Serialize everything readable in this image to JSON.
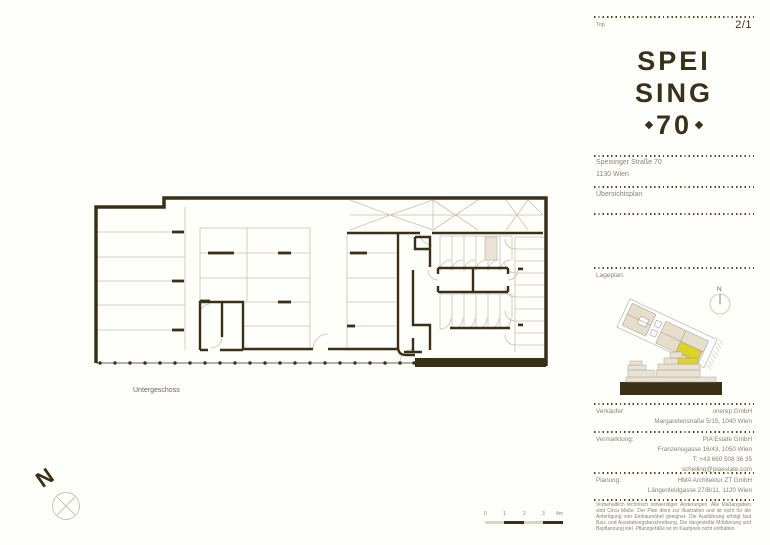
{
  "header": {
    "top_label": "Top",
    "page_number": "2/1"
  },
  "logo": {
    "line1": "SPEI",
    "line2": "SING",
    "number": "70"
  },
  "project": {
    "address_line1": "Speisinger Straße 70",
    "address_line2": "1130 Wien",
    "plan_type": "Übersichtsplan"
  },
  "siteplan": {
    "label": "Lageplan:",
    "compass_label": "N"
  },
  "plan": {
    "floor_label": "Untergeschoss",
    "north_label": "N"
  },
  "scalebar": {
    "labels": [
      "0",
      "1",
      "2",
      "3",
      "4m"
    ]
  },
  "contacts": [
    {
      "label": "Verkäufer:",
      "lines": [
        "onerep GmbH",
        "Margaretenstraße 5/15, 1040 Wien"
      ]
    },
    {
      "label": "Vermarktung:",
      "lines": [
        "PIA Estate GmbH",
        "Franzensgasse 16/43, 1050 Wien",
        "T: +43 660 508 36 35",
        "schelling@piaestate.com"
      ]
    },
    {
      "label": "Planung:",
      "lines": [
        "HMA Architektur ZT GmbH",
        "Längenfeldgasse 27/B/11, 1120 Wien"
      ]
    }
  ],
  "disclaimer": "Vorbehaltlich technisch notwendiger Änderungen. Alle Maßangaben sind Circa Maße. Der Plan dient zur Illustration und ist nicht für die Anfertigung von Einbaumöbel geeignet. Die Ausführung erfolgt laut Bau- und Ausstattungsbeschreibung. Die dargestellte Möblierung und Bepflanzung inkl. Pflanzgefäße ist im Kaufpreis nicht enthalten.",
  "colors": {
    "wall": "#3a3018",
    "muted_text": "#8b8375",
    "light_line": "#c6c1b2",
    "beige_fill": "#eae2d3",
    "accent_yellow": "#ddd327"
  }
}
